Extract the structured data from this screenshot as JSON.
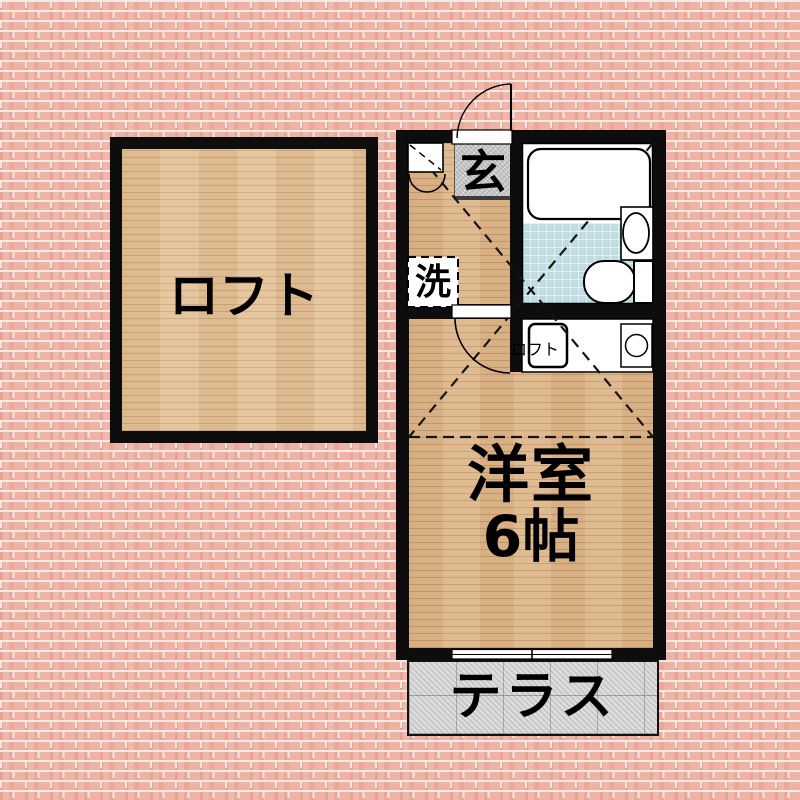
{
  "plan": {
    "loft_room": {
      "label": "ロフト"
    },
    "unit": {
      "entrance_label": "玄",
      "washer_label": "洗",
      "loft_access_label": "ロフト",
      "main_room_label": "洋室",
      "main_room_size": "6帖",
      "terrace_label": "テラス"
    },
    "colors": {
      "brick": "#eead9f",
      "mortar": "#f6e8e4",
      "wall": "#0d0d0d",
      "wood_floor": "#ddb588",
      "loft_wood_floor": "#e3c096",
      "bath_tile_blue": "#c0dce3",
      "genkan_gray": "#c9c9c9",
      "terrace_concrete": "#d4d4d4"
    }
  }
}
